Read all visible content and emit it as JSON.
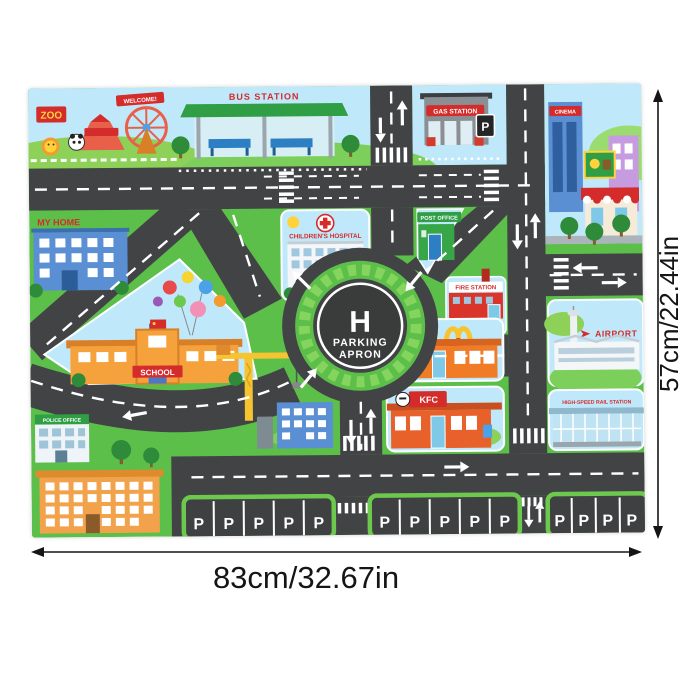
{
  "product": {
    "dimensions": {
      "width_label": "83cm/32.67in",
      "height_label": "57cm/22.44in"
    }
  },
  "mat": {
    "labels": {
      "zoo": "ZOO",
      "welcome": "WELCOME!",
      "bus_station": "BUS STATION",
      "gas_station": "GAS STATION",
      "cinema": "CINEMA",
      "my_home": "MY HOME",
      "hospital": "CHILDREN'S HOSPITAL",
      "post_office": "POST OFFICE",
      "fire_station": "FIRE STATION",
      "school": "SCHOOL",
      "police_office": "POLICE OFFICE",
      "airport": "AIRPORT",
      "rail_station": "HIGH-SPEED RAIL STATION",
      "kfc": "KFC",
      "helipad_letter": "H",
      "helipad_line1": "PARKING",
      "helipad_line2": "APRON",
      "parking_letter": "P"
    },
    "colors": {
      "road": "#414345",
      "grass": "#5cbf4a",
      "sky": "#bfe9fa",
      "sign_red": "#d42b2b",
      "sign_green": "#2f9e44"
    }
  }
}
